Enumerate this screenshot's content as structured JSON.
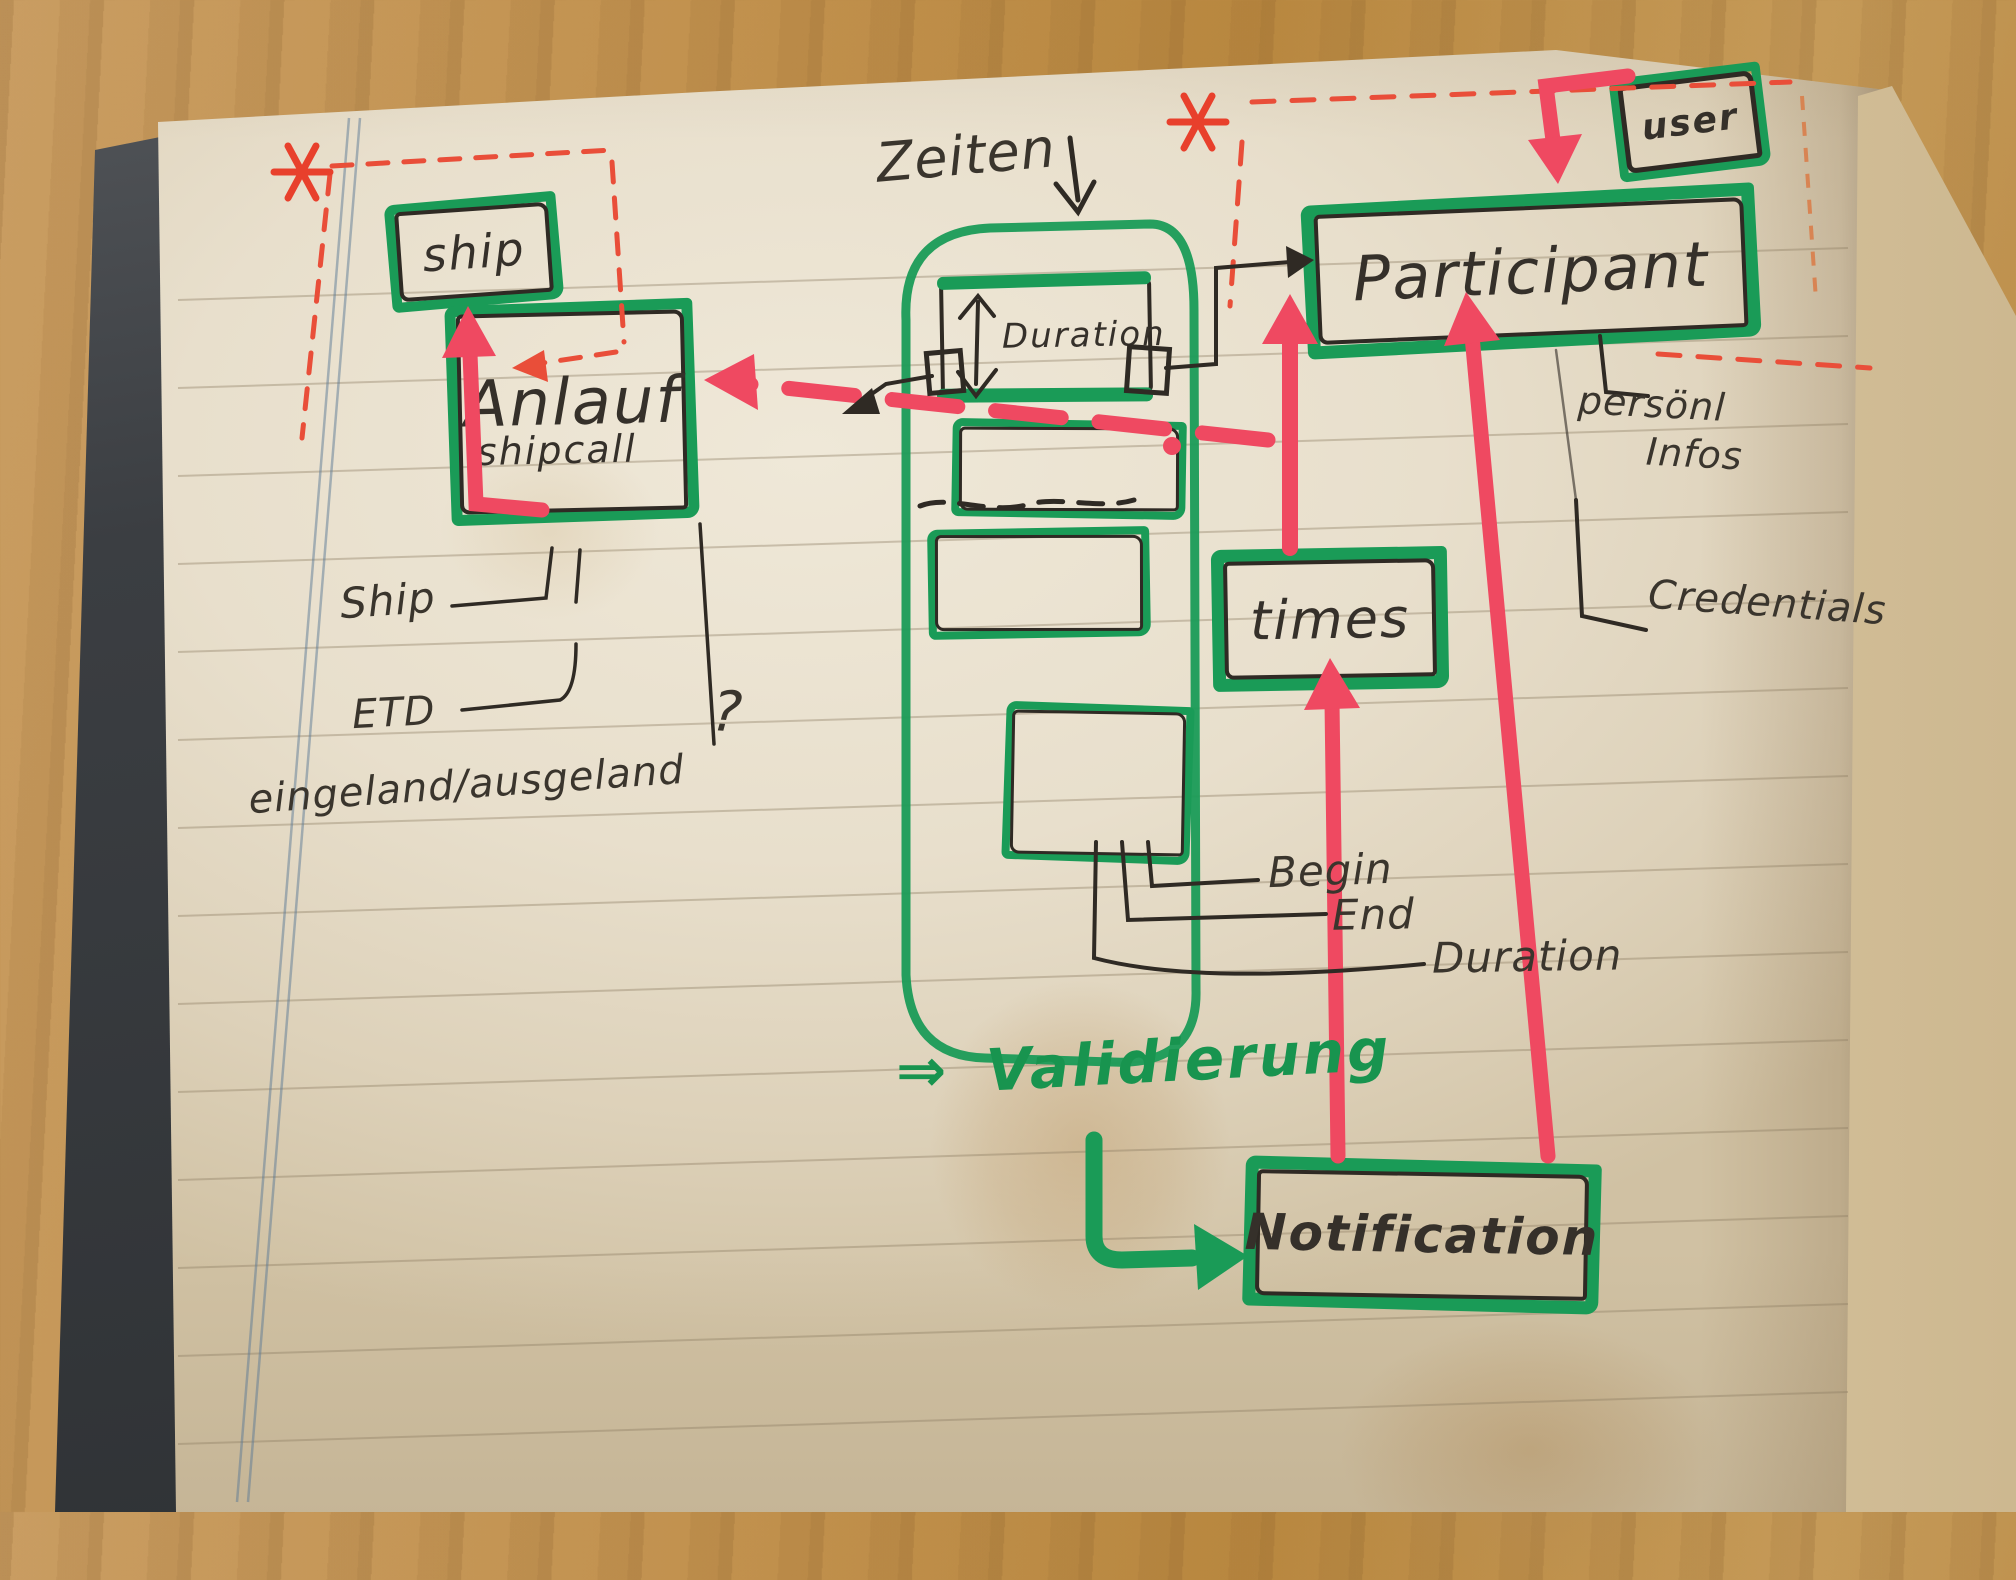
{
  "diagram": {
    "nodes": {
      "ship": {
        "label": "ship"
      },
      "anlauf": {
        "label": "Anlauf",
        "sublabel": "shipcall"
      },
      "duration_box": {
        "label": "Duration"
      },
      "participant": {
        "label": "Participant"
      },
      "user": {
        "label": "user"
      },
      "times": {
        "label": "times"
      },
      "notification": {
        "label": "Notification"
      }
    },
    "annotations": {
      "zeiten": "Zeiten",
      "ship_attribute": "Ship",
      "eta_attribute": "ETD",
      "eingeland": "eingeland/ausgeland",
      "question_mark": "?",
      "personal_line1": "persönl",
      "personal_line2": "Infos",
      "credentials": "Credentials",
      "begin": "Begin",
      "end": "End",
      "duration": "Duration",
      "validierung_prefix": "⇒",
      "validierung": "Validierung"
    },
    "colors": {
      "marker_green": "#1a9b57",
      "marker_red": "#ef4961",
      "dash_red_pen": "#e94e39",
      "pen_black": "#2f2a24",
      "page_cream": "#e8dfcc"
    }
  }
}
